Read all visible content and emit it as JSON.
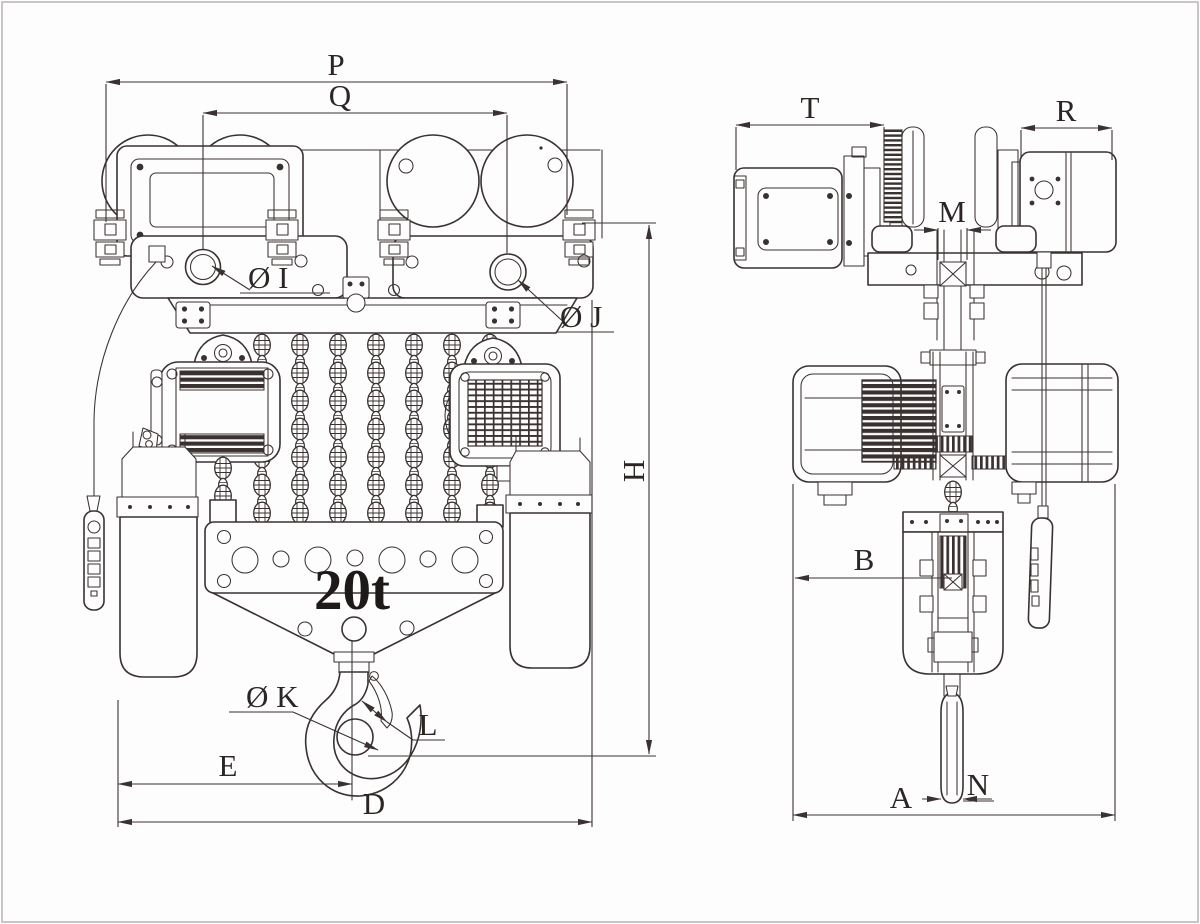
{
  "drawing": {
    "capacity": "20t",
    "labels": {
      "p": "P",
      "q": "Q",
      "i": "Ø I",
      "j": "Ø J",
      "h": "H",
      "e": "E",
      "d": "D",
      "k": "Ø K",
      "l": "L",
      "t": "T",
      "r": "R",
      "m": "M",
      "b": "B",
      "a": "A",
      "n": "N"
    },
    "colors": {
      "line": "#3a3231",
      "text": "#2b2523",
      "background": "#fdfdfd",
      "border": "#b9b4b1"
    }
  }
}
